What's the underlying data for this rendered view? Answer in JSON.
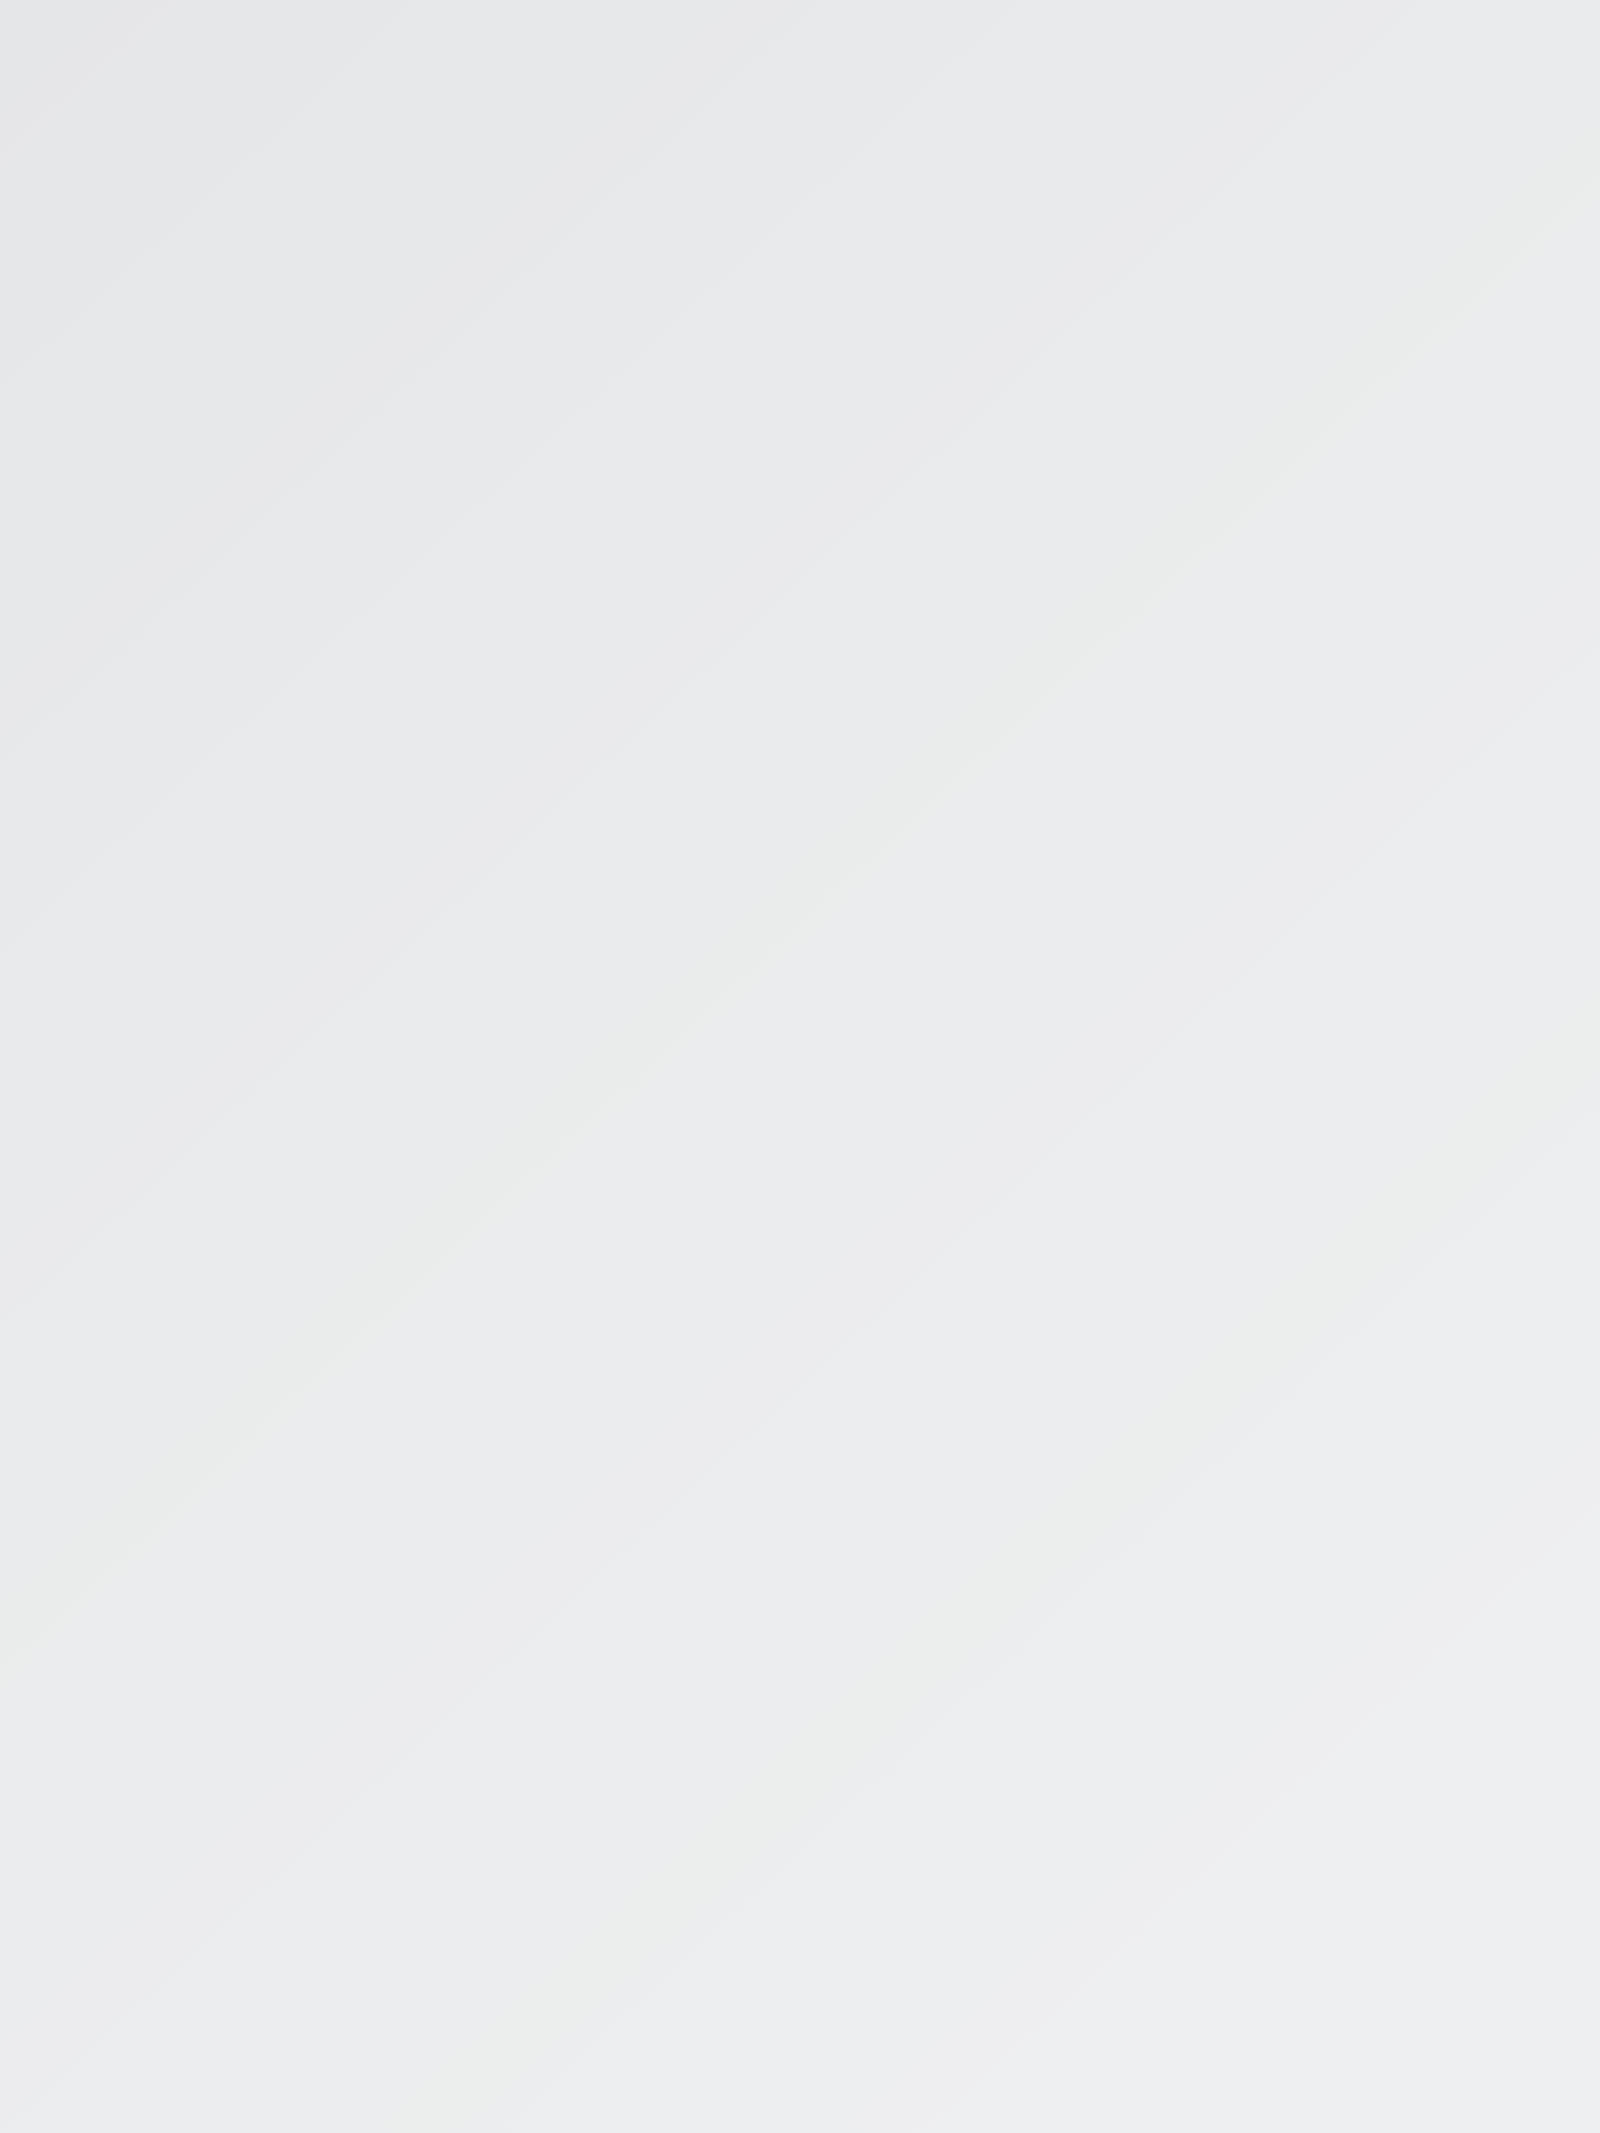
{
  "meta": {
    "description": "Product photo: transparent acrylic hexagon patchwork quilting ruler lying on a light gray surface, photographed at an angle"
  },
  "colors": {
    "background_top": "#e5e6e8",
    "background_bottom": "#eeeff0",
    "acrylic_top": "#f8f9fa",
    "acrylic_bottom": "#ffffff",
    "print": "#1c1c1c",
    "edge_line": "#c6c8c9",
    "bevel_highlight": "#ffffff",
    "line_shadow": "#8f8f8f",
    "hole_ring": "#bdbdbd",
    "hole_shade": "#c9c9c9",
    "hole_light": "#fdfdfd"
  },
  "ruler": {
    "name": "HEXAGON",
    "unit": "(CM)",
    "model": "#MHEX14",
    "brand_top": "ART UZOR",
    "brand_bottom": "SIMA LAND",
    "outer_size_label": "15.5",
    "partial_size_label": "1",
    "dashed_size_labels": [
      "14",
      "12",
      "10",
      "8"
    ],
    "edge_scale": {
      "numbers": [
        0,
        1,
        2,
        3,
        4,
        5,
        6,
        7,
        8,
        9
      ],
      "ticks_per_cm": 10,
      "total_mm": 91
    },
    "hole_count": 8
  },
  "geometry": {
    "body_path": "M 25 926 L 1082 345 Q 1112 329 1132 347 L 1600 551 L 1600 2133 L 0 2133 L 0 1632 Z",
    "bevel_lines": [
      {
        "pts": [
          [
            28,
            921
          ],
          [
            1086,
            340
          ]
        ],
        "color": "#ffffff",
        "w": 7,
        "o": 0.9
      },
      {
        "pts": [
          [
            1135,
            352
          ],
          [
            1600,
            559
          ]
        ],
        "color": "#ffffff",
        "w": 7,
        "o": 0.9
      },
      {
        "pts": [
          [
            1140,
            312
          ],
          [
            1600,
            514
          ]
        ],
        "color": "#d6d6d6",
        "w": 2.5,
        "o": 0.8
      },
      {
        "pts": [
          [
            22,
            934
          ],
          [
            2,
            1560
          ]
        ],
        "color": "#f4f4f4",
        "w": 5,
        "o": 0.9
      }
    ],
    "scale": {
      "base": [
        30,
        923
      ],
      "step": [
        11.65,
        -6.4
      ],
      "inward": [
        0.481,
        0.876
      ],
      "len_minor": 28,
      "len_half": 40,
      "len_cm": 52,
      "num_start": [
        68,
        993
      ],
      "num_step": [
        117.5,
        -64.5
      ],
      "num_rot": -28,
      "num_size": 42
    },
    "solid_hexagons": [
      [
        [
          61,
          2133
        ],
        [
          134,
          1110
        ],
        [
          1092,
          457
        ],
        [
          1600,
          690
        ]
      ],
      [
        [
          365,
          2133
        ],
        [
          407,
          1130
        ],
        [
          1238,
          668
        ],
        [
          1600,
          810
        ]
      ],
      [
        [
          648,
          2133
        ],
        [
          685,
          1287
        ],
        [
          1392,
          893
        ],
        [
          1600,
          976
        ]
      ],
      [
        [
          948,
          2133
        ],
        [
          975,
          1460
        ],
        [
          1548,
          1133
        ],
        [
          1600,
          1154
        ]
      ],
      [
        [
          1312,
          2133
        ],
        [
          1289,
          1633
        ],
        [
          1600,
          1424
        ]
      ]
    ],
    "dashed_hexagons": [
      [
        [
          258,
          2133
        ],
        [
          308,
          1077
        ],
        [
          1160,
          601
        ],
        [
          1600,
          748
        ]
      ],
      [
        [
          536,
          2133
        ],
        [
          582,
          1248
        ],
        [
          1290,
          835
        ],
        [
          1600,
          956
        ]
      ],
      [
        [
          838,
          2133
        ],
        [
          870,
          1432
        ],
        [
          1458,
          1043
        ],
        [
          1600,
          1101
        ]
      ],
      [
        [
          1146,
          2133
        ],
        [
          1180,
          1565
        ],
        [
          1600,
          1316
        ]
      ],
      [
        [
          1470,
          2133
        ],
        [
          1488,
          1750
        ],
        [
          1600,
          1686
        ]
      ]
    ],
    "line_shadows": [
      {
        "pts": [
          [
            420,
            883
          ],
          [
            1087,
            430
          ]
        ],
        "dash": false
      },
      {
        "pts": [
          [
            382,
            1001
          ],
          [
            1142,
            532
          ]
        ],
        "dash": true
      },
      {
        "pts": [
          [
            502,
            1048
          ],
          [
            1232,
            642
          ]
        ],
        "dash": false
      },
      {
        "pts": [
          [
            652,
            1174
          ],
          [
            1282,
            771
          ]
        ],
        "dash": true
      }
    ],
    "holes": [
      [
        1092,
        457
      ],
      [
        1238,
        668
      ],
      [
        1392,
        893
      ],
      [
        1548,
        1133
      ],
      [
        134,
        1110
      ],
      [
        407,
        1130
      ],
      [
        685,
        1287
      ],
      [
        975,
        1460
      ]
    ],
    "hole_r": 28,
    "leaders_bottom": [
      [
        [
          143,
          2133
        ],
        [
          263,
          1947
        ]
      ],
      [
        [
          441,
          2133
        ],
        [
          561,
          1950
        ]
      ],
      [
        [
          735,
          2133
        ],
        [
          849,
          1952
        ]
      ],
      [
        [
          1070,
          2133
        ],
        [
          1166,
          1965
        ]
      ],
      [
        [
          1395,
          2133
        ],
        [
          1483,
          1972
        ]
      ]
    ],
    "size_labels": [
      {
        "x": 1100,
        "y": 600,
        "arrow": [
          1142,
          508
        ],
        "leader": [
          [
            1068,
            632
          ],
          [
            1046,
            664
          ]
        ]
      },
      {
        "x": 1247,
        "y": 808,
        "arrow": [
          1284,
          718
        ],
        "leader": [
          [
            1222,
            838
          ],
          [
            1200,
            886
          ]
        ]
      },
      {
        "x": 1398,
        "y": 1030,
        "arrow": [
          1434,
          948
        ],
        "leader": [
          [
            1370,
            1062
          ],
          [
            1348,
            1116
          ]
        ]
      },
      {
        "x": 1548,
        "y": 1263,
        "arrow": [
          1594,
          1186
        ],
        "leader": [
          [
            1528,
            1300
          ],
          [
            1490,
            1380
          ]
        ]
      }
    ],
    "label_rot": -28,
    "label_size": 54,
    "arrow_dir": [
      0.42,
      -0.907
    ],
    "brand_boxes": [
      {
        "cx": 658,
        "cy": 795,
        "w": 312,
        "h": 112,
        "rot": -28.5,
        "size": 48,
        "ls": 2
      },
      {
        "cx": 814,
        "cy": 1005,
        "w": 350,
        "h": 108,
        "rot": -28.6,
        "size": 44,
        "ls": 5
      }
    ],
    "outer_label_pos": {
      "x": 1492,
      "y": 575,
      "rot": 23.5,
      "size": 46
    },
    "partial_label_pos": {
      "x": 1592,
      "y": 800,
      "rot": 23.5,
      "size": 46
    },
    "vertical_texts": {
      "name": {
        "start": [
          221,
          1277
        ],
        "step": [
          -9,
          64
        ],
        "size": 62
      },
      "unit": {
        "start": [
          157,
          1758
        ],
        "step": [
          -4.5,
          46
        ],
        "size": 44
      },
      "model": {
        "start": [
          487,
          1273
        ],
        "step": [
          -5,
          55
        ],
        "size": 48
      }
    }
  }
}
